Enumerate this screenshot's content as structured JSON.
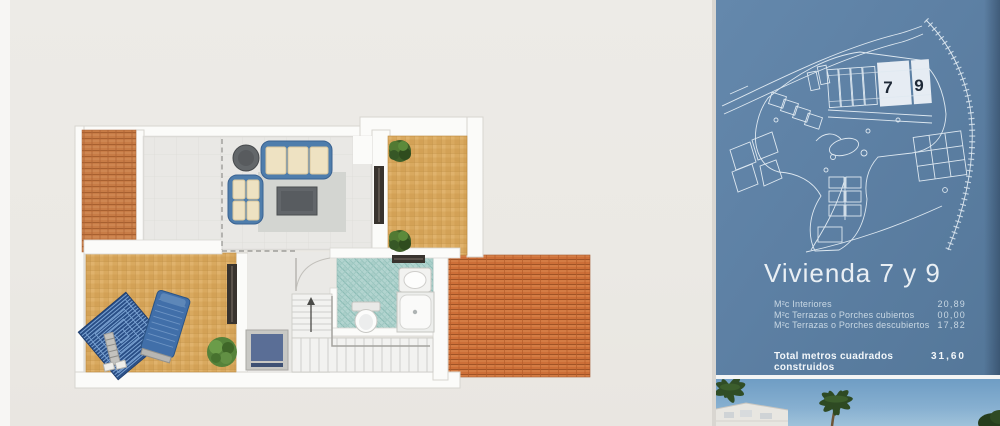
{
  "panel": {
    "title": "Vivienda 7 y 9",
    "site_plan_units": [
      "7",
      "9"
    ],
    "stats": [
      {
        "label": "M²c Interiores",
        "value": "20,89"
      },
      {
        "label": "M²c Terrazas o Porches cubiertos",
        "value": "00,00"
      },
      {
        "label": "M²c Terrazas o Porches descubiertos",
        "value": "17,82"
      }
    ],
    "total_label": "Total metros cuadrados construidos",
    "total_value": "31,60",
    "colors": {
      "panel_blue": "#5d80a4",
      "blueprint_line": "#e9f1f7",
      "unit_number": "#1e2836"
    }
  },
  "floor_plan": {
    "elements": [
      "roof-left",
      "roof-right",
      "living-room",
      "dining-area",
      "upper-terrace",
      "lower-terrace",
      "bathroom",
      "staircase",
      "entry-door",
      "sofa-set",
      "coffee-table",
      "round-table",
      "rug",
      "sun-lounger",
      "beach-towel",
      "planter-bushes",
      "blue-mat",
      "sink",
      "shower",
      "toilet"
    ],
    "colors": {
      "wall": "#fbfbf9",
      "terrace_tile": "#d9a95f",
      "roof_tile": "#cd6f38",
      "bath_tile": "#b2d4cf",
      "sofa_blue": "#4e7dac",
      "background": "#ecebe7"
    }
  }
}
